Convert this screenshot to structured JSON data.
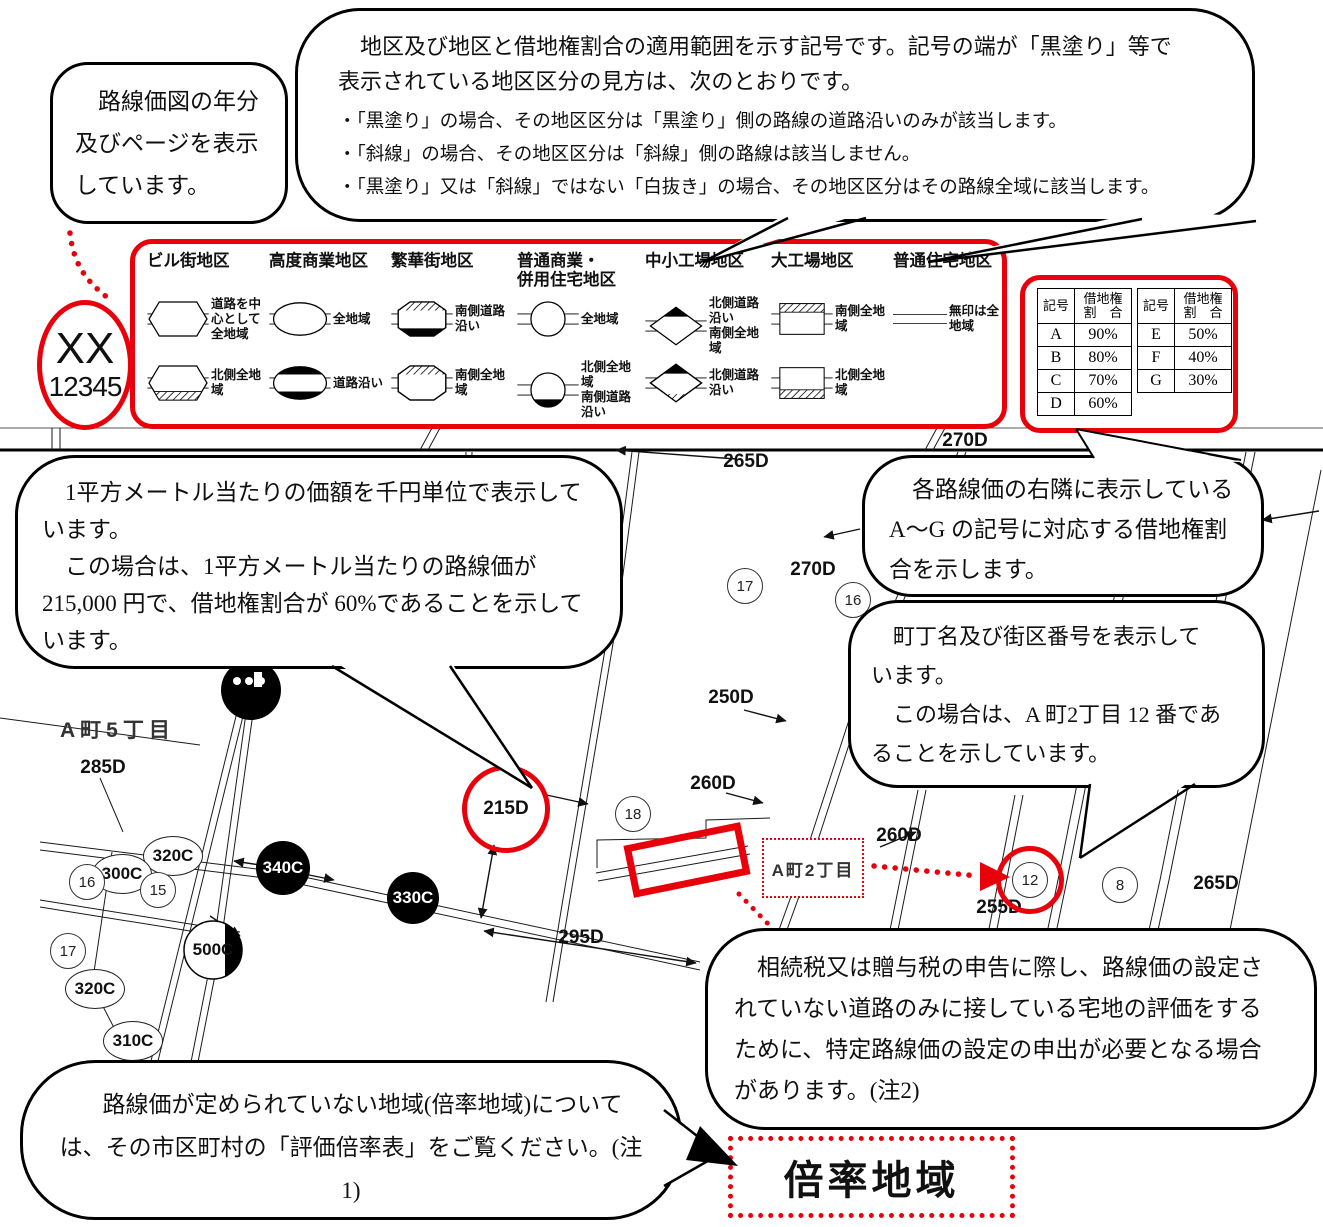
{
  "stamp": {
    "year": "XX",
    "page": "12345"
  },
  "callouts": {
    "year_page": {
      "text": "　路線価図の年分\n及びページを表示\nしています。"
    },
    "district_symbols": {
      "intro": "　地区及び地区と借地権割合の適用範囲を示す記号です。記号の端が「黒塗り」等で\n表示されている地区区分の見方は、次のとおりです。",
      "bullets": [
        "・「黒塗り」の場合、その地区区分は「黒塗り」側の路線の道路沿いのみが該当します。",
        "・「斜線」の場合、その地区区分は「斜線」側の路線は該当しません。",
        "・「黒塗り」又は「斜線」ではない「白抜き」の場合、その地区区分はその路線全域に該当します。"
      ]
    },
    "price_per_sqm": {
      "text": "　1平方メートル当たりの価額を千円単位で表示して\nいます。\n　この場合は、1平方メートル当たりの路線価が\n215,000 円で、借地権割合が 60%であることを示して\nいます。"
    },
    "leasehold_ratio": {
      "text": "　各路線価の右隣に表示している\nA〜G の記号に対応する借地権割\n合を示します。"
    },
    "block_number": {
      "text": "　町丁名及び街区番号を表示して\nいます。\n　この場合は、A 町2丁目 12 番であ\nることを示しています。"
    },
    "specific_route_price": {
      "text": "　相続税又は贈与税の申告に際し、路線価の設定さ\nれていない道路のみに接している宅地の評価をする\nために、特定路線価の設定の申出が必要となる場合\nがあります。(注2)"
    },
    "multiplier_area": {
      "text": "　路線価が定められていない地域(倍率地域)について\nは、その市区町村の「評価倍率表」をご覧ください。(注1)"
    }
  },
  "legend": {
    "districts": [
      {
        "name": "ビル街地区",
        "rows": [
          {
            "symbol": "hexagon-white",
            "label": "道路を中心として全地域"
          },
          {
            "symbol": "hexagon-hatched-bottom",
            "label": "北側全地域"
          }
        ]
      },
      {
        "name": "高度商業地区",
        "rows": [
          {
            "symbol": "ellipse-white",
            "label": "全地域"
          },
          {
            "symbol": "ellipse-black-top-bottom",
            "label": "道路沿い"
          }
        ]
      },
      {
        "name": "繁華街地区",
        "rows": [
          {
            "symbol": "octagon-hatched-top-black-bottom",
            "label": "南側道路沿い"
          },
          {
            "symbol": "octagon-hatched-top",
            "label": "南側全地域"
          }
        ]
      },
      {
        "name": "普通商業・\n併用住宅地区",
        "rows": [
          {
            "symbol": "circle-white",
            "label": "全地域"
          },
          {
            "symbol": "circle-black-bottom",
            "label": "北側全地域\n南側道路沿い"
          }
        ]
      },
      {
        "name": "中小工場地区",
        "rows": [
          {
            "symbol": "diamond-black-top",
            "label": "北側道路沿い\n南側全地域"
          },
          {
            "symbol": "diamond-black-top-hatched-bottom",
            "label": "北側道路沿い"
          }
        ]
      },
      {
        "name": "大工場地区",
        "rows": [
          {
            "symbol": "rect-hatched-top",
            "label": "南側全地域"
          },
          {
            "symbol": "rect-hatched-bottom",
            "label": "北側全地域"
          }
        ]
      },
      {
        "name": "普通住宅地区",
        "rows": [
          {
            "symbol": "plain-line",
            "label": "無印は全地域"
          }
        ]
      }
    ]
  },
  "ratio_tables": [
    {
      "col1": "記号",
      "col2": "借地権\n割　合",
      "rows": [
        [
          "A",
          "90%"
        ],
        [
          "B",
          "80%"
        ],
        [
          "C",
          "70%"
        ],
        [
          "D",
          "60%"
        ]
      ]
    },
    {
      "col1": "記号",
      "col2": "借地権\n割　合",
      "rows": [
        [
          "E",
          "50%"
        ],
        [
          "F",
          "40%"
        ],
        [
          "G",
          "30%"
        ]
      ]
    }
  ],
  "map": {
    "area_labels": {
      "a5": "A町5丁目",
      "a2": "A町2丁目"
    },
    "multiplier_box": "倍率地域",
    "highlight_price": "215D",
    "highlight_block": "12",
    "road_values": [
      {
        "text": "270D"
      },
      {
        "text": "265D"
      },
      {
        "text": "270D"
      },
      {
        "text": "250D"
      },
      {
        "text": "260D"
      },
      {
        "text": "260D"
      },
      {
        "text": "255D"
      },
      {
        "text": "265D"
      },
      {
        "text": "285D"
      },
      {
        "text": "295D"
      }
    ],
    "price_circles": [
      {
        "text": "320C"
      },
      {
        "text": "300C"
      },
      {
        "text": "340C"
      },
      {
        "text": "330C"
      },
      {
        "text": "500C"
      },
      {
        "text": "320C"
      },
      {
        "text": "310C"
      }
    ],
    "block_numbers": [
      {
        "text": "17"
      },
      {
        "text": "16"
      },
      {
        "text": "18"
      },
      {
        "text": "15"
      },
      {
        "text": "16"
      },
      {
        "text": "17"
      },
      {
        "text": "8"
      }
    ]
  }
}
